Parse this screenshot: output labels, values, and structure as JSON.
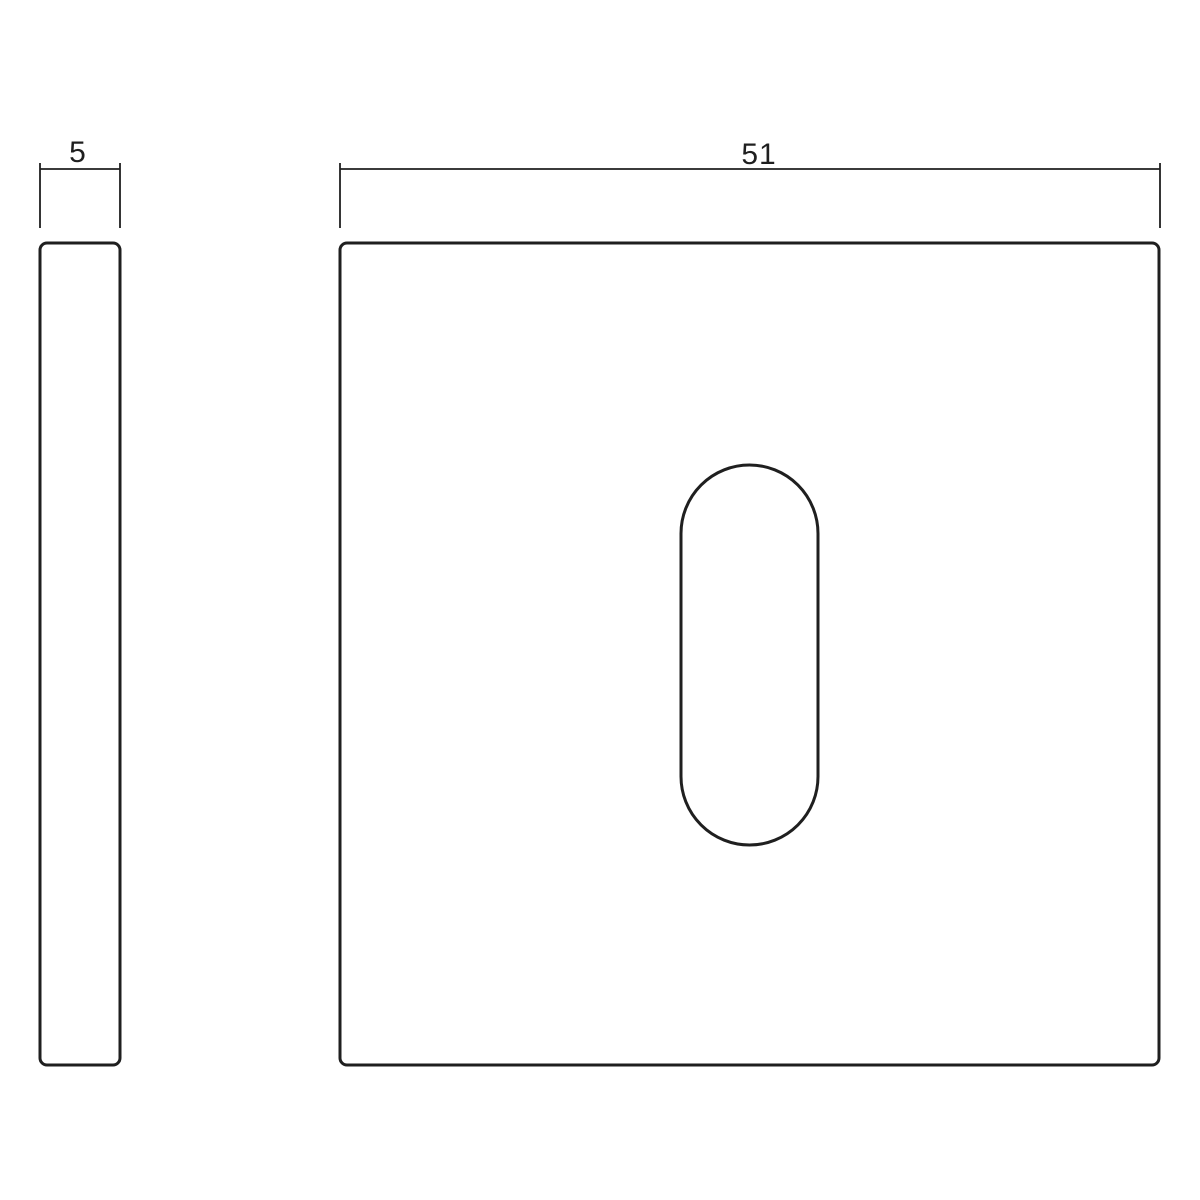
{
  "drawing": {
    "kind": "technical-drawing",
    "background_color": "#ffffff",
    "stroke_color": "#1f1f1f",
    "views": {
      "side": {
        "dimension_label": "5"
      },
      "front": {
        "dimension_label": "51"
      }
    }
  }
}
